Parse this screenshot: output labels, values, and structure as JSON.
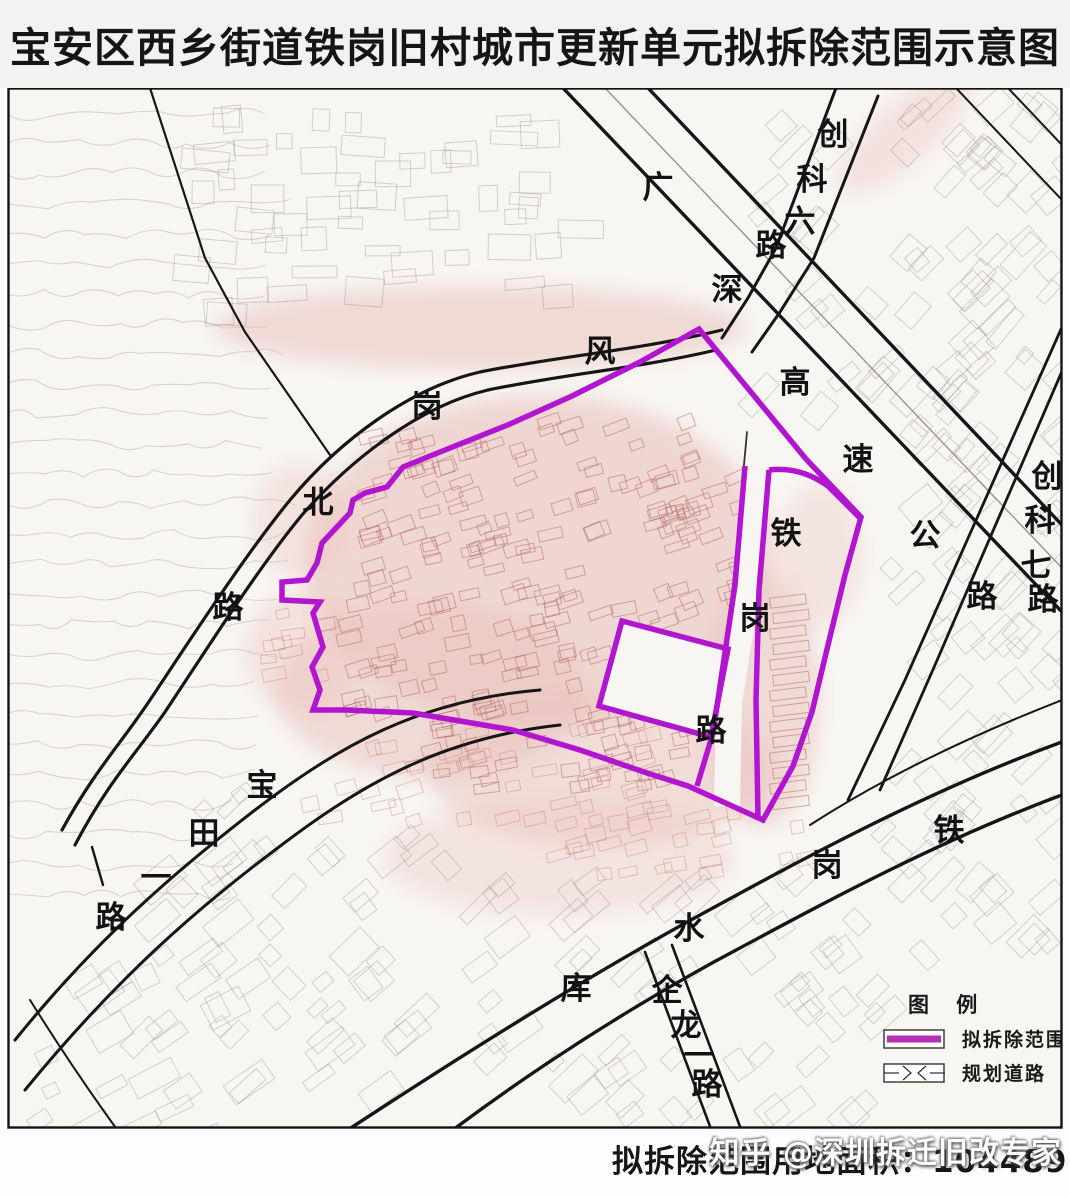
{
  "title": "宝安区西乡街道铁岗旧村城市更新单元拟拆除范围示意图",
  "colors": {
    "boundary": "#b215cf",
    "legend_line": "#b52fb5",
    "road": "#161616",
    "pink_shade": "#eac2bd",
    "paper": "#f8f6f3"
  },
  "legend": {
    "heading": "图 例",
    "items": [
      {
        "label": "拟拆除范围",
        "type": "demolition-extent"
      },
      {
        "label": "规划道路",
        "type": "planned-road"
      }
    ]
  },
  "footer": {
    "area_label": "拟拆除范围用地面积：104489㎡"
  },
  "watermark": "知乎 @深圳拆迁旧改专家",
  "road_labels": [
    {
      "id": "fenggang-north-road",
      "name": "风岗北路",
      "chars": [
        {
          "c": "风",
          "x": 600,
          "y": 352
        },
        {
          "c": "岗",
          "x": 427,
          "y": 407
        },
        {
          "c": "北",
          "x": 318,
          "y": 503
        },
        {
          "c": "路",
          "x": 228,
          "y": 608
        }
      ]
    },
    {
      "id": "baotian-first-road",
      "name": "宝田一路",
      "chars": [
        {
          "c": "宝",
          "x": 262,
          "y": 786
        },
        {
          "c": "田",
          "x": 204,
          "y": 834
        },
        {
          "c": "一",
          "x": 156,
          "y": 878
        },
        {
          "c": "路",
          "x": 111,
          "y": 918
        }
      ]
    },
    {
      "id": "guangshen-expressway",
      "name": "广深高速公路",
      "chars": [
        {
          "c": "广",
          "x": 658,
          "y": 188
        },
        {
          "c": "深",
          "x": 727,
          "y": 290
        },
        {
          "c": "高",
          "x": 795,
          "y": 383
        },
        {
          "c": "速",
          "x": 858,
          "y": 460
        },
        {
          "c": "公",
          "x": 925,
          "y": 536
        },
        {
          "c": "路",
          "x": 982,
          "y": 597
        }
      ]
    },
    {
      "id": "chuangke-6-road",
      "name": "创科六路",
      "chars": [
        {
          "c": "创",
          "x": 833,
          "y": 135
        },
        {
          "c": "科",
          "x": 812,
          "y": 180
        },
        {
          "c": "六",
          "x": 800,
          "y": 222
        },
        {
          "c": "路",
          "x": 771,
          "y": 246
        }
      ]
    },
    {
      "id": "chuangke-7-road",
      "name": "创科七路",
      "chars": [
        {
          "c": "创",
          "x": 1047,
          "y": 477
        },
        {
          "c": "科",
          "x": 1040,
          "y": 521
        },
        {
          "c": "七",
          "x": 1036,
          "y": 566
        },
        {
          "c": "路",
          "x": 1043,
          "y": 600
        }
      ]
    },
    {
      "id": "tiegang-road",
      "name": "铁岗路",
      "chars": [
        {
          "c": "铁",
          "x": 786,
          "y": 534
        },
        {
          "c": "岗",
          "x": 755,
          "y": 619
        },
        {
          "c": "路",
          "x": 711,
          "y": 731
        }
      ]
    },
    {
      "id": "tiegang-reservoir",
      "name": "铁岗水库",
      "chars": [
        {
          "c": "铁",
          "x": 949,
          "y": 831
        },
        {
          "c": "岗",
          "x": 827,
          "y": 866
        },
        {
          "c": "水",
          "x": 689,
          "y": 929
        },
        {
          "c": "库",
          "x": 576,
          "y": 989
        }
      ]
    },
    {
      "id": "qilong-first-road",
      "name": "企龙一路",
      "chars": [
        {
          "c": "企",
          "x": 667,
          "y": 991
        },
        {
          "c": "龙",
          "x": 686,
          "y": 1026
        },
        {
          "c": "一",
          "x": 699,
          "y": 1056
        },
        {
          "c": "路",
          "x": 707,
          "y": 1085
        }
      ]
    }
  ]
}
